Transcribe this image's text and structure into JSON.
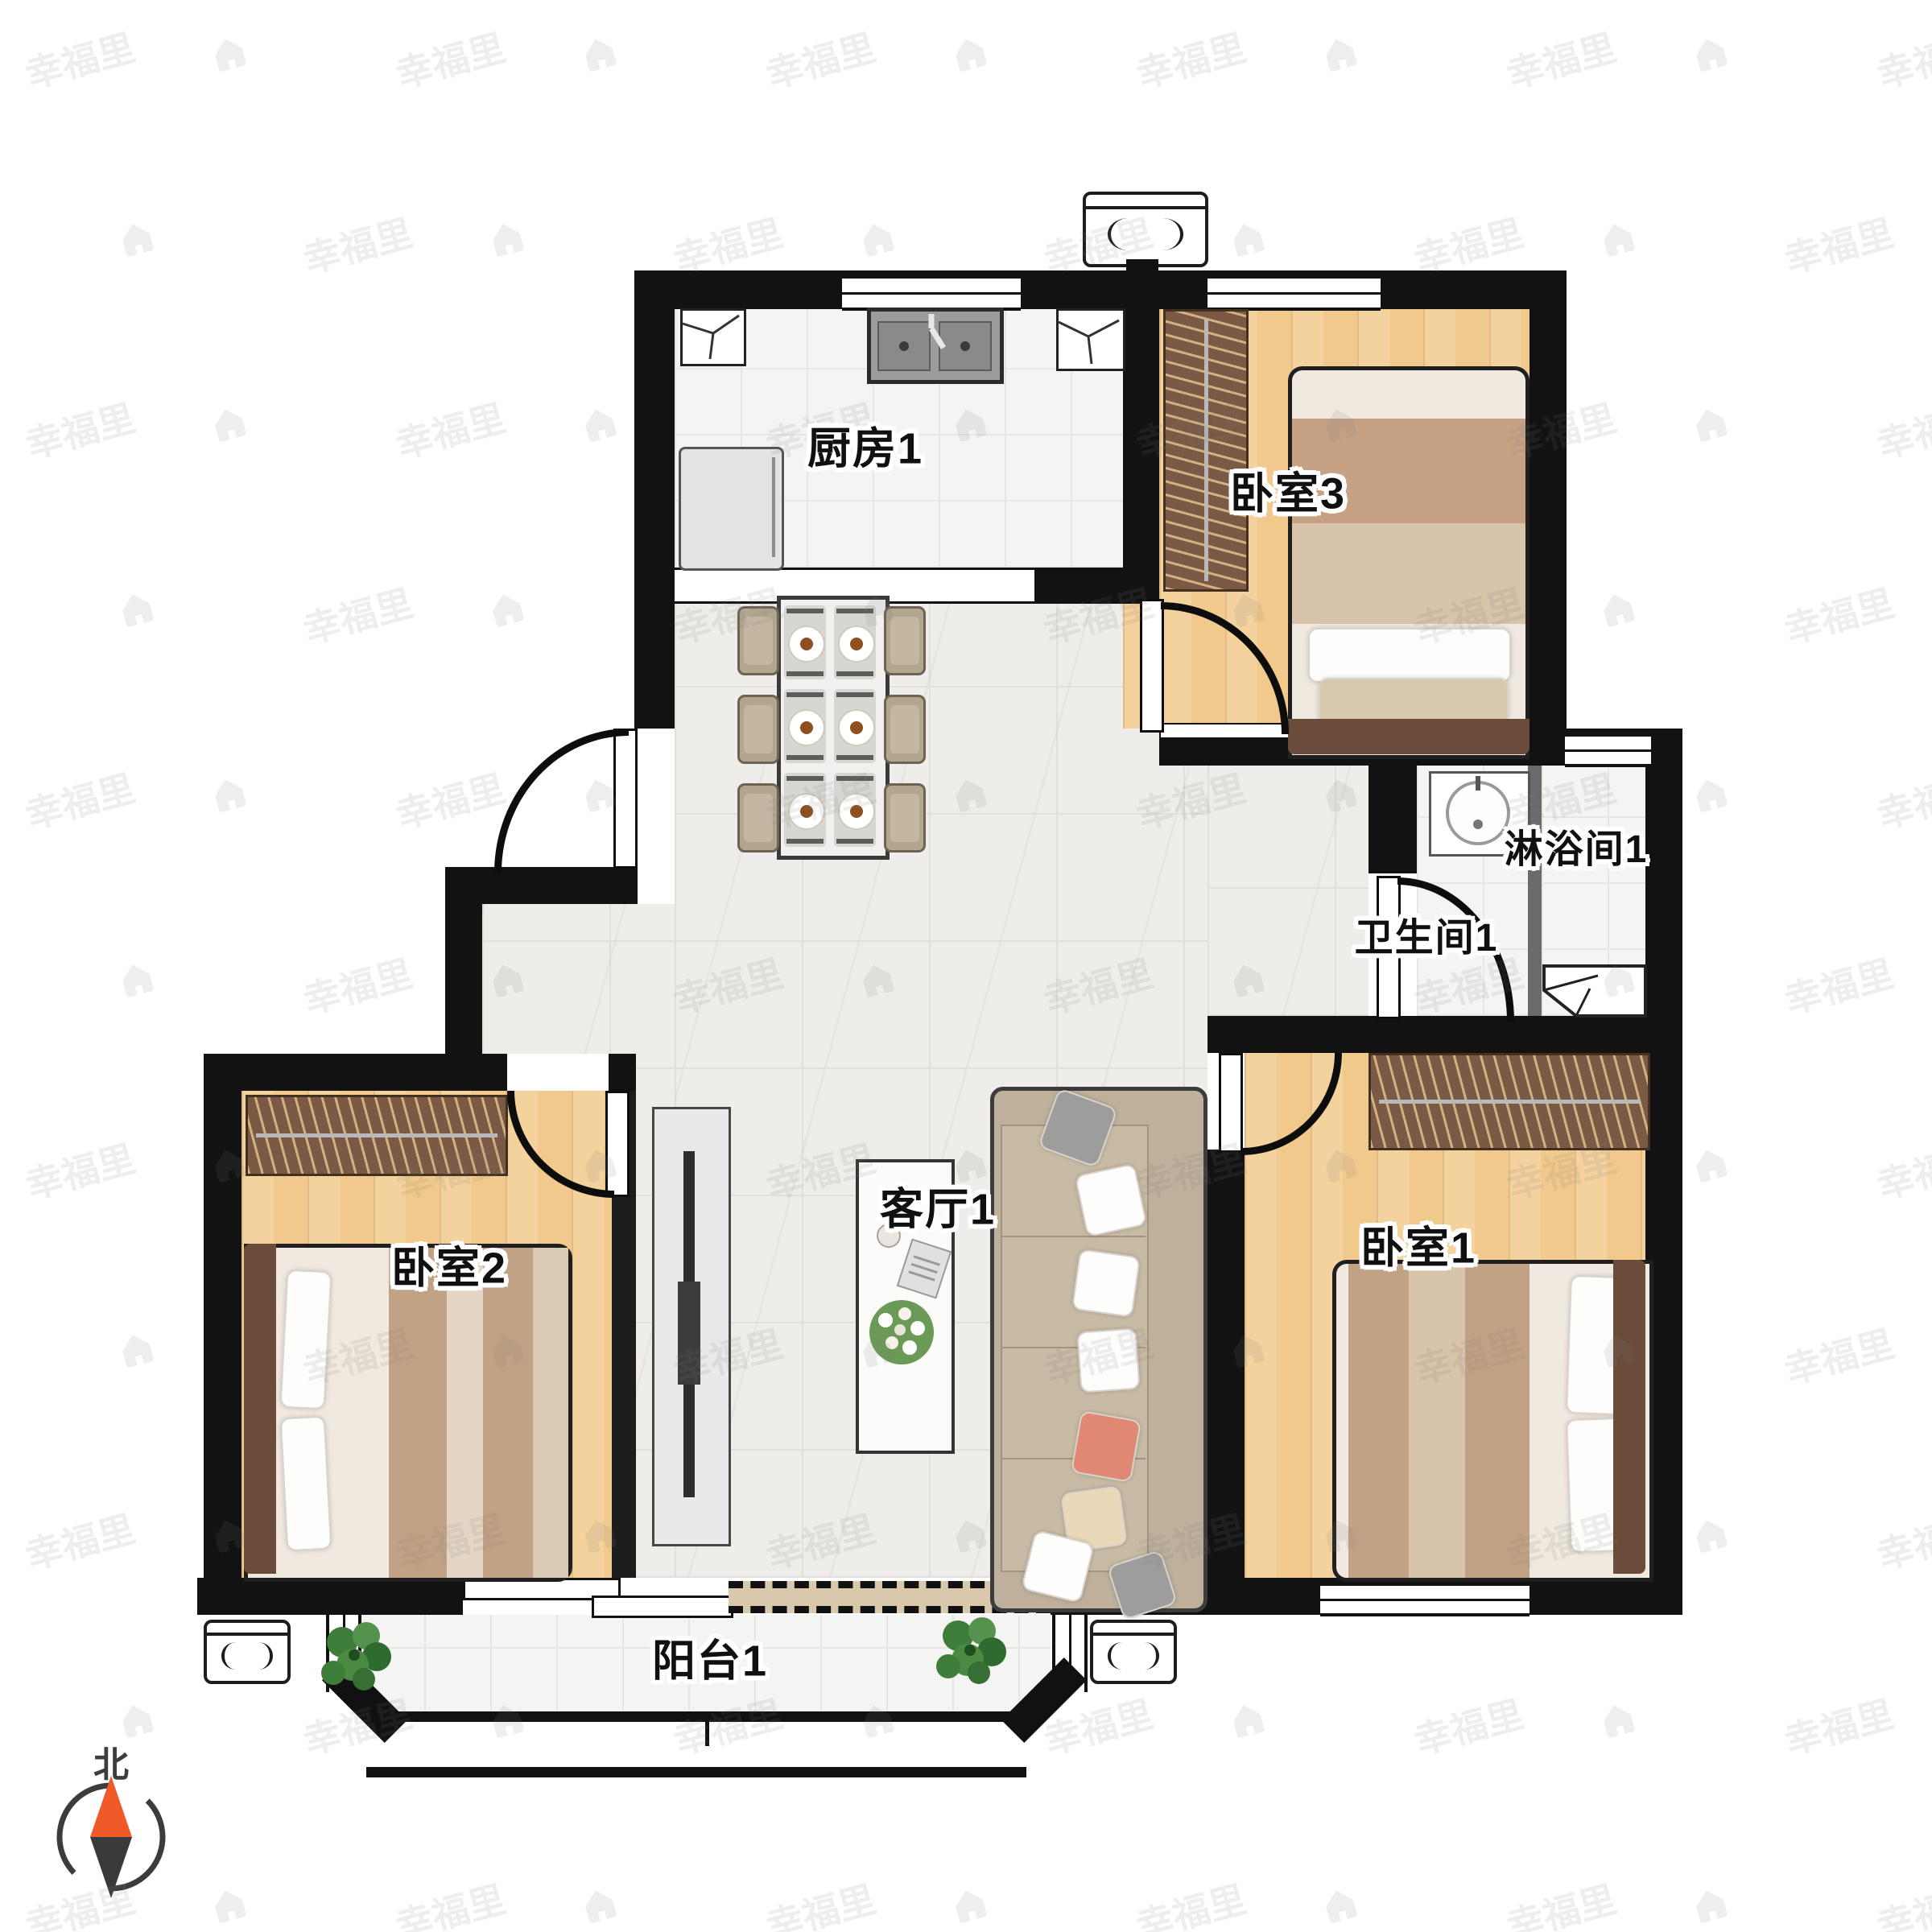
{
  "rooms": [
    {
      "id": "kitchen",
      "label": "厨房1"
    },
    {
      "id": "bedroom3",
      "label": "卧室3"
    },
    {
      "id": "shower",
      "label": "淋浴间1"
    },
    {
      "id": "bathroom",
      "label": "卫生间1"
    },
    {
      "id": "living",
      "label": "客厅1"
    },
    {
      "id": "bedroom2",
      "label": "卧室2"
    },
    {
      "id": "bedroom1",
      "label": "卧室1"
    },
    {
      "id": "balcony",
      "label": "阳台1"
    }
  ],
  "compass": {
    "north_label": "北"
  },
  "watermark": {
    "text": "幸福里"
  },
  "colors": {
    "wall": "#121212",
    "wood_floor": "#f2c98c",
    "tile_floor": "#f4f4f2",
    "marble_floor": "#efedea",
    "wardrobe": "#7a5a44",
    "compass_north": "#f05a28",
    "compass_south": "#3a3a3a"
  }
}
